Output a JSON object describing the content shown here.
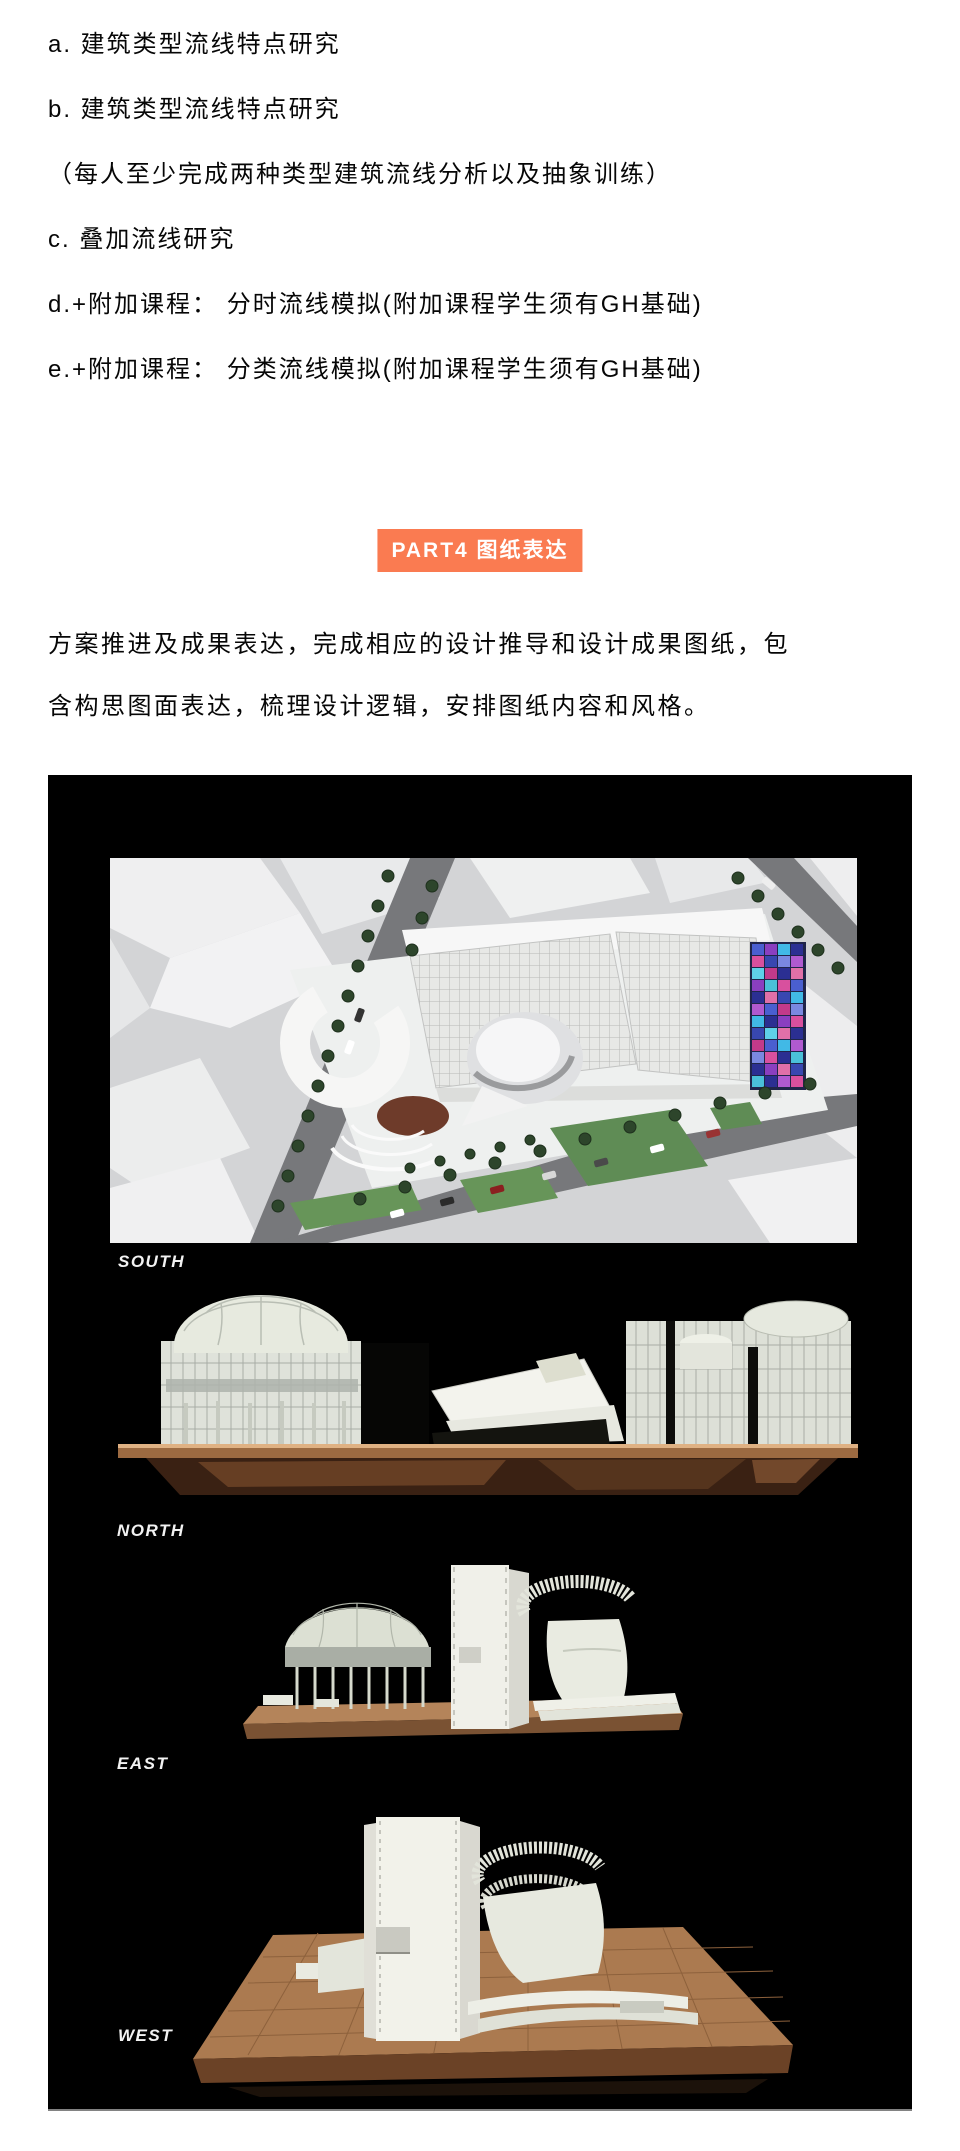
{
  "course_list": {
    "items": [
      "a. 建筑类型流线特点研究",
      "b. 建筑类型流线特点研究",
      "（每人至少完成两种类型建筑流线分析以及抽象训练）",
      "c. 叠加流线研究",
      "d.+附加课程： 分时流线模拟(附加课程学生须有GH基础)",
      "e.+附加课程： 分类流线模拟(附加课程学生须有GH基础)"
    ]
  },
  "section_badge": {
    "label": "PART4 图纸表达",
    "background_color": "#fa7b51",
    "text_color": "#ffffff"
  },
  "paragraph": {
    "lines": [
      "方案推进及成果表达，完成相应的设计推导和设计成果图纸，包",
      "含构思图面表达，梳理设计逻辑，安排图纸内容和风格。"
    ]
  },
  "figure": {
    "background_color": "#000000",
    "label_color": "#f2f2f2",
    "views": [
      {
        "label": "SOUTH"
      },
      {
        "label": "NORTH"
      },
      {
        "label": "EAST"
      },
      {
        "label": "WEST"
      }
    ],
    "palette": {
      "copper_base": "#9c6a41",
      "wood_base": "#ab7a50",
      "model_white": "#f0f0ea",
      "road_gray": "#77787b",
      "lawn_green": "#5f8c55",
      "plaza_brown": "#6e3b2a"
    }
  }
}
